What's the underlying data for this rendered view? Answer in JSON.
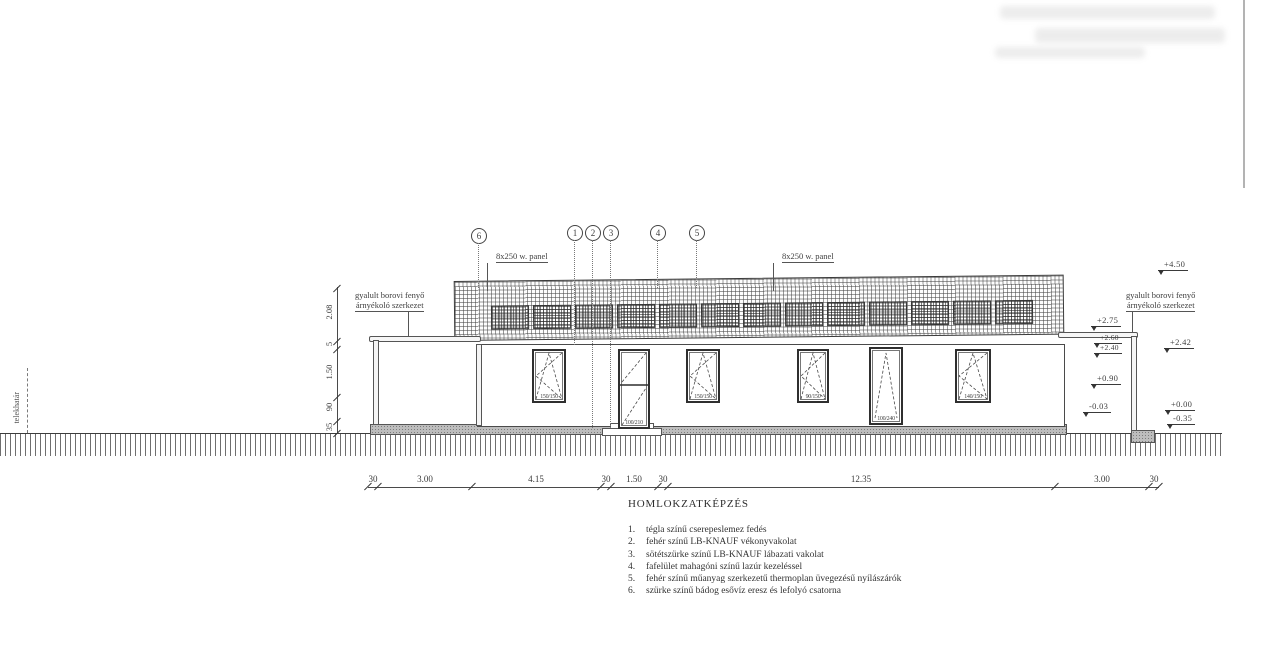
{
  "drawing": {
    "ink": "#3f3f3f",
    "bg": "#ffffff",
    "boundary_label": "telekhatár",
    "legend": {
      "title": "HOMLOKZATKÉPZÉS",
      "items": [
        {
          "num": "1.",
          "text": "tégla színű cserepeslemez fedés"
        },
        {
          "num": "2.",
          "text": "fehér színű LB-KNAUF vékonyvakolat"
        },
        {
          "num": "3.",
          "text": "sötétszürke színű LB-KNAUF lábazati vakolat"
        },
        {
          "num": "4.",
          "text": "fafelület mahagóni színű lazúr kezeléssel"
        },
        {
          "num": "5.",
          "text": "fehér színű műanyag szerkezetű thermoplan üvegezésű nyílászárók"
        },
        {
          "num": "6.",
          "text": "szürke színű bádog esővíz eresz és lefolyó csatorna"
        }
      ]
    },
    "callouts": [
      {
        "n": "6",
        "x": 478,
        "y": 228,
        "drop": 288
      },
      {
        "n": "1",
        "x": 574,
        "y": 225,
        "drop": 345
      },
      {
        "n": "2",
        "x": 592,
        "y": 225,
        "drop": 428
      },
      {
        "n": "3",
        "x": 610,
        "y": 225,
        "drop": 428
      },
      {
        "n": "4",
        "x": 657,
        "y": 225,
        "drop": 288
      },
      {
        "n": "5",
        "x": 696,
        "y": 225,
        "drop": 288
      }
    ],
    "panel_labels": [
      {
        "text": "8x250 w. panel",
        "x": 496,
        "y": 251,
        "leader_x": 487,
        "leader_drop": 28
      },
      {
        "text": "8x250 w. panel",
        "x": 782,
        "y": 251,
        "leader_x": 773,
        "leader_drop": 28
      }
    ],
    "shade_notes": [
      {
        "line1": "gyalult borovi fenyő",
        "line2": "árnyékoló szerkezet",
        "x": 355,
        "y": 291,
        "leader_x": 408,
        "leader_y1": 312,
        "leader_y2": 336
      },
      {
        "line1": "gyalult borovi fenyő",
        "line2": "árnyékoló szerkezet",
        "x": 1126,
        "y": 291,
        "leader_x": 1132,
        "leader_y1": 312,
        "leader_y2": 332
      }
    ],
    "levels": [
      {
        "text": "+4.50",
        "x": 1158,
        "y": 259,
        "small": false
      },
      {
        "text": "+2.75",
        "x": 1091,
        "y": 315,
        "small": false
      },
      {
        "text": "+2.60",
        "x": 1094,
        "y": 333,
        "small": true
      },
      {
        "text": "+2.40",
        "x": 1094,
        "y": 343,
        "small": true
      },
      {
        "text": "+2.42",
        "x": 1164,
        "y": 337,
        "small": false
      },
      {
        "text": "+0.90",
        "x": 1091,
        "y": 373,
        "small": false
      },
      {
        "text": "-0.03",
        "x": 1083,
        "y": 401,
        "small": false
      },
      {
        "text": "+0.00",
        "x": 1165,
        "y": 399,
        "small": false
      },
      {
        "text": "-0.35",
        "x": 1167,
        "y": 413,
        "small": false
      }
    ],
    "dim_bottom": {
      "y": 487,
      "x1": 368,
      "x2": 1159,
      "ticks": [
        368,
        378,
        472,
        601,
        611,
        658,
        668,
        1055,
        1149,
        1159
      ],
      "labels": [
        {
          "t": "30",
          "x": 373
        },
        {
          "t": "3.00",
          "x": 425
        },
        {
          "t": "4.15",
          "x": 536
        },
        {
          "t": "30",
          "x": 606
        },
        {
          "t": "1.50",
          "x": 634
        },
        {
          "t": "30",
          "x": 663
        },
        {
          "t": "12.35",
          "x": 861
        },
        {
          "t": "3.00",
          "x": 1102
        },
        {
          "t": "30",
          "x": 1154
        }
      ]
    },
    "dim_left": {
      "x": 337,
      "y1": 287,
      "y2": 433,
      "ticks": [
        288,
        341,
        349,
        397,
        421,
        433
      ],
      "labels": [
        {
          "t": "2.08",
          "y": 312
        },
        {
          "t": "5",
          "y": 344
        },
        {
          "t": "1.50",
          "y": 372
        },
        {
          "t": "90",
          "y": 407
        },
        {
          "t": "35",
          "y": 427
        }
      ]
    },
    "building": {
      "roof": {
        "x": 454,
        "y": 281,
        "w": 608,
        "h": 58,
        "panel_count": 13,
        "panel_x0": 36,
        "panel_w": 36,
        "panel_gap": 6,
        "panel_y": 24,
        "panel_h": 22
      },
      "wall": {
        "x": 477,
        "y": 344,
        "w": 586,
        "h": 81
      },
      "plinth": {
        "x": 370,
        "y": 424,
        "w": 695,
        "h": 9
      },
      "terrain": {
        "x": 0,
        "y": 433,
        "w": 1222,
        "h": 22
      },
      "posts": [
        {
          "x": 373,
          "y": 340,
          "w": 4,
          "h": 83
        },
        {
          "x": 476,
          "y": 344,
          "w": 4,
          "h": 80
        },
        {
          "x": 1131,
          "y": 336,
          "w": 4,
          "h": 93
        }
      ],
      "beams": [
        {
          "x": 369,
          "y": 336,
          "w": 110,
          "h": 4
        },
        {
          "x": 1058,
          "y": 332,
          "w": 78,
          "h": 4
        }
      ],
      "stoop_upper": {
        "x": 610,
        "y": 423,
        "w": 42,
        "h": 5
      },
      "stoop_lower": {
        "x": 602,
        "y": 428,
        "w": 58,
        "h": 6
      },
      "right_step": {
        "x": 1131,
        "y": 430,
        "w": 22,
        "h": 11
      },
      "boundary": {
        "x": 27,
        "y1": 368,
        "y2": 433,
        "label_x": 12,
        "label_y": 392
      }
    },
    "windows": [
      {
        "x": 532,
        "y": 349,
        "w": 30,
        "h": 50,
        "label": "150/150",
        "sym": "turn"
      },
      {
        "x": 618,
        "y": 349,
        "w": 28,
        "h": 76,
        "label": "100/210",
        "sym": "door"
      },
      {
        "x": 686,
        "y": 349,
        "w": 30,
        "h": 50,
        "label": "150/150",
        "sym": "turn"
      },
      {
        "x": 797,
        "y": 349,
        "w": 28,
        "h": 50,
        "label": "90/150",
        "sym": "turn"
      },
      {
        "x": 869,
        "y": 347,
        "w": 30,
        "h": 74,
        "label": "100/240",
        "sym": "tall"
      },
      {
        "x": 955,
        "y": 349,
        "w": 32,
        "h": 50,
        "label": "140/150",
        "sym": "turn"
      }
    ],
    "artifacts": {
      "ghost_line": {
        "x": 1243,
        "y": 0,
        "h": 188
      },
      "smudges": [
        {
          "x": 1000,
          "y": 6,
          "w": 215,
          "h": 13
        },
        {
          "x": 1035,
          "y": 28,
          "w": 190,
          "h": 15
        },
        {
          "x": 995,
          "y": 47,
          "w": 150,
          "h": 11
        }
      ]
    }
  }
}
